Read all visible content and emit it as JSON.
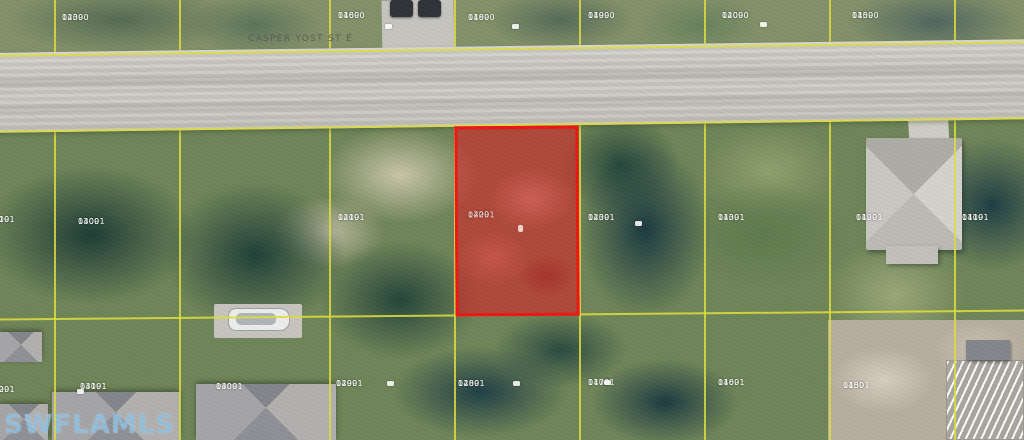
{
  "scene": {
    "type": "aerial-parcel-map",
    "street_label": "CASPER YOST ST E",
    "watermark": "SWFLAMLS",
    "highlight_parcel": {
      "block": "14091",
      "lot": "0220"
    },
    "colors": {
      "parcel_line": "#dede3c",
      "highlight_fill": "rgba(225,25,35,0.55)",
      "highlight_border": "#ee1515",
      "label_text": "#ffffff",
      "watermark_text": "rgba(140,190,224,0.8)",
      "road": "#cbc9c3"
    },
    "grid": {
      "vertical_x": [
        55,
        180,
        330,
        455,
        580,
        705,
        830,
        955
      ],
      "horizontal_lines": [
        {
          "y": 48,
          "rot": -0.75
        },
        {
          "y": 124,
          "rot": -0.75
        },
        {
          "y": 314,
          "rot": -0.5
        }
      ]
    },
    "parcel_labels": [
      {
        "block": "14090",
        "lot": "0230",
        "x": 62,
        "y": 14
      },
      {
        "block": "14090",
        "lot": "0160",
        "x": 338,
        "y": 12
      },
      {
        "block": "14090",
        "lot": "0180",
        "x": 468,
        "y": 14
      },
      {
        "block": "14090",
        "lot": "0190",
        "x": 588,
        "y": 12
      },
      {
        "block": "14090",
        "lot": "0200",
        "x": 722,
        "y": 12
      },
      {
        "block": "14090",
        "lot": "0150",
        "x": 852,
        "y": 12
      },
      {
        "block": "14091",
        "lot": "0310",
        "x": -12,
        "y": 216
      },
      {
        "block": "14091",
        "lot": "0300",
        "x": 78,
        "y": 218
      },
      {
        "block": "14091",
        "lot": "0210",
        "x": 338,
        "y": 214
      },
      {
        "block": "14091",
        "lot": "0230",
        "x": 588,
        "y": 214
      },
      {
        "block": "14091",
        "lot": "0130",
        "x": 718,
        "y": 214
      },
      {
        "block": "14091",
        "lot": "0120",
        "x": 856,
        "y": 214
      },
      {
        "block": "14091",
        "lot": "0110",
        "x": 962,
        "y": 214
      },
      {
        "block": "14091",
        "lot": "0320",
        "x": -12,
        "y": 386
      },
      {
        "block": "14091",
        "lot": "0310",
        "x": 80,
        "y": 383
      },
      {
        "block": "14091",
        "lot": "0300",
        "x": 216,
        "y": 383
      },
      {
        "block": "14091",
        "lot": "0290",
        "x": 336,
        "y": 380
      },
      {
        "block": "14091",
        "lot": "0280",
        "x": 458,
        "y": 380
      },
      {
        "block": "14091",
        "lot": "0170",
        "x": 588,
        "y": 379
      },
      {
        "block": "14091",
        "lot": "0160",
        "x": 718,
        "y": 379
      },
      {
        "block": "14091",
        "lot": "0150",
        "x": 843,
        "y": 382
      }
    ],
    "marker_dots": [
      {
        "x": 385,
        "y": 24
      },
      {
        "x": 512,
        "y": 24
      },
      {
        "x": 760,
        "y": 22
      },
      {
        "x": 635,
        "y": 221
      },
      {
        "x": 387,
        "y": 381
      },
      {
        "x": 513,
        "y": 381
      },
      {
        "x": 604,
        "y": 380
      },
      {
        "x": 77,
        "y": 389
      }
    ]
  }
}
